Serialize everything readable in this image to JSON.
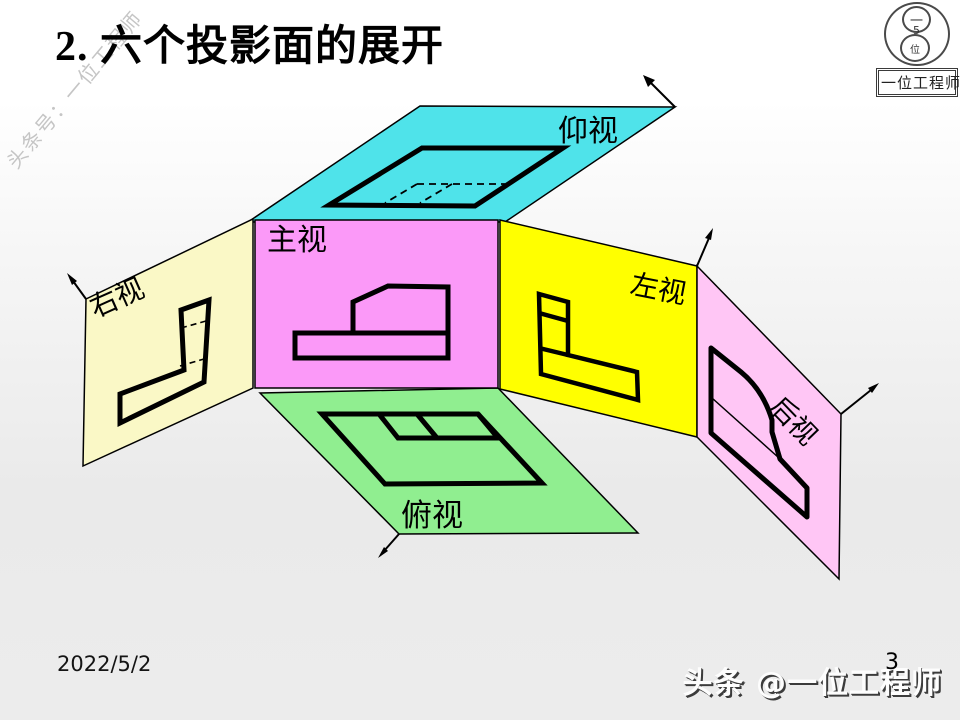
{
  "slide": {
    "title": "2. 六个投影面的展开"
  },
  "logo": {
    "monogram_top": "一",
    "monogram_middle": "5",
    "monogram_bottom": "位",
    "box_label": "一位工程师"
  },
  "watermarks": {
    "left": "头条号：一位工程师",
    "bottom_right": "头条 @一位工程师"
  },
  "footer": {
    "date": "2022/5/2",
    "page_number": "3"
  },
  "diagram": {
    "stroke_color": "#000000",
    "views": {
      "bottom_view": {
        "label": "仰视",
        "color": "#4fe3ea"
      },
      "front_view": {
        "label": "主视",
        "color": "#fb99f8"
      },
      "right_view": {
        "label": "右视",
        "color": "#faf8c6"
      },
      "left_view": {
        "label": "左视",
        "color": "#ffff00"
      },
      "top_view": {
        "label": "俯视",
        "color": "#90ee90"
      },
      "rear_view": {
        "label": "后视",
        "color": "#ffc6f5"
      }
    }
  }
}
